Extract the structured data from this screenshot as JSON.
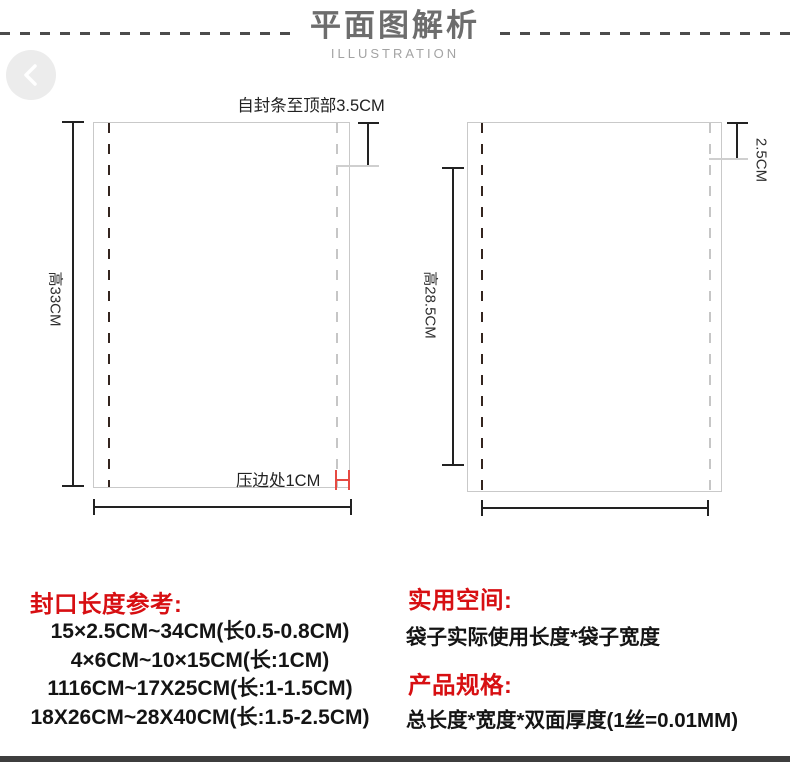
{
  "header": {
    "title": "平面图解析",
    "subtitle": "ILLUSTRATION",
    "back_icon": "chevron-left"
  },
  "diagram": {
    "left_bag": {
      "top_label": "自封条至顶部3.5CM",
      "height_label": "高33CM",
      "press_edge_label": "压边处1CM"
    },
    "right_bag": {
      "zip_label": "2.5CM",
      "height_label": "高28.5CM"
    },
    "colors": {
      "outline": "#c9c9c9",
      "dimension_line": "#222222",
      "dark_dash": "#34251f",
      "light_dash": "#c6c6c6",
      "highlight_red": "#e64a42"
    }
  },
  "specs": {
    "heading_color": "#d70f12",
    "seal_reference": {
      "heading": "封口长度参考:",
      "lines": [
        "15×2.5CM~34CM(长0.5-0.8CM)",
        "4×6CM~10×15CM(长:1CM)",
        "1116CM~17X25CM(长:1-1.5CM)",
        "18X26CM~28X40CM(长:1.5-2.5CM)"
      ]
    },
    "usable_space": {
      "heading": "实用空间:",
      "text": "袋子实际使用长度*袋子宽度"
    },
    "product_spec": {
      "heading": "产品规格:",
      "text": "总长度*宽度*双面厚度(1丝=0.01MM)"
    }
  }
}
